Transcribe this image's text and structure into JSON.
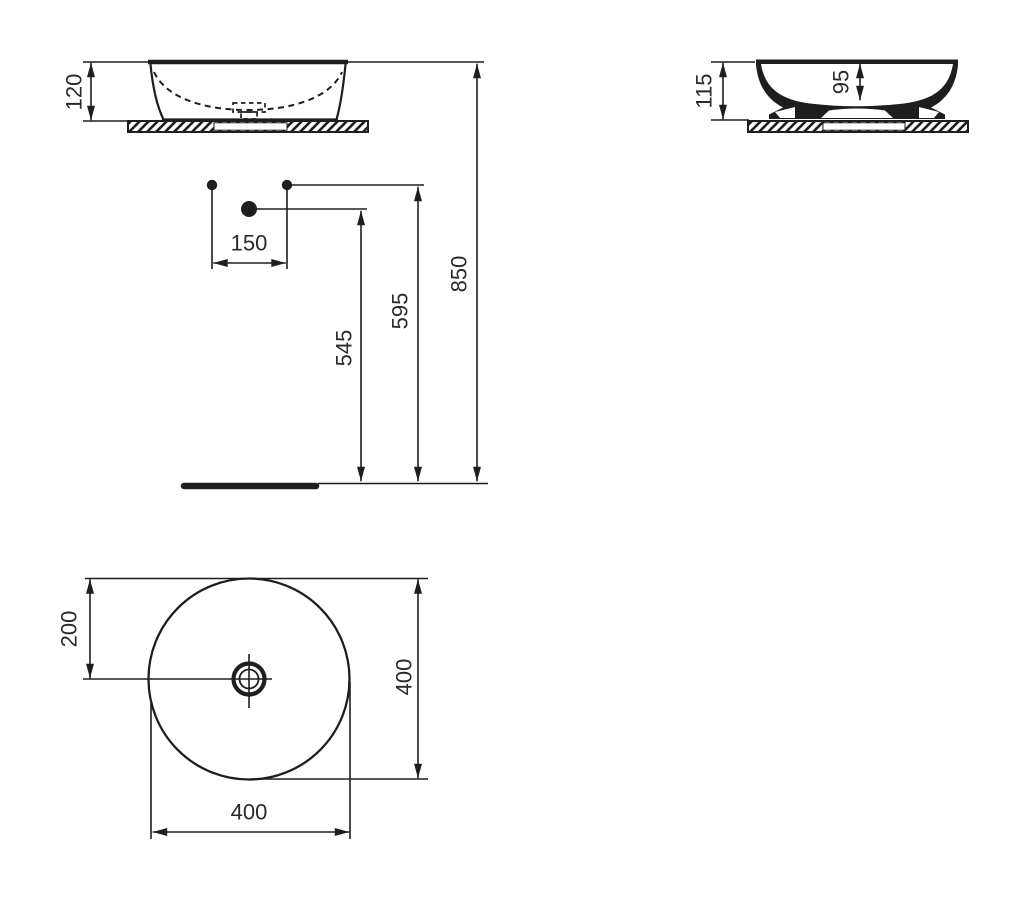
{
  "colors": {
    "line": "#1e1e1e",
    "text": "#2a2a2a",
    "background": "#ffffff"
  },
  "views": {
    "front": {
      "height": "120"
    },
    "side_section": {
      "overall_height": "115",
      "bowl_depth": "95"
    },
    "installation": {
      "tap_hole_spacing": "150",
      "drain_height": "545",
      "tap_hole_height": "595",
      "rim_height": "850"
    },
    "plan": {
      "edge_to_center": "200",
      "diameter_vertical": "400",
      "diameter_horizontal": "400"
    }
  }
}
